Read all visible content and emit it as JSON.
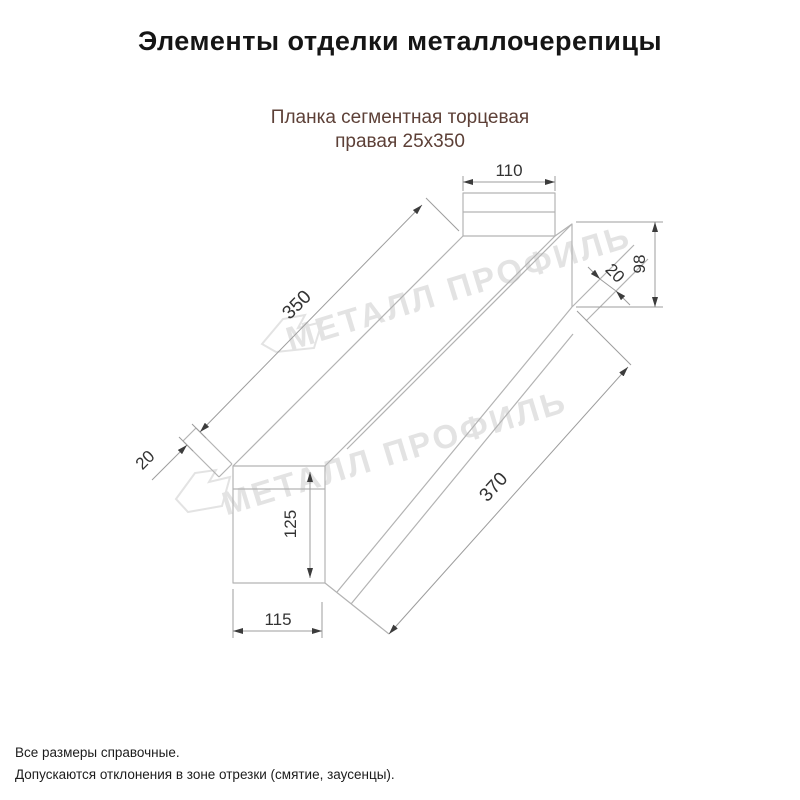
{
  "title": "Элементы отделки металлочерепицы",
  "product": {
    "line1": "Планка сегментная торцевая",
    "line2": "правая 25х350"
  },
  "drawing": {
    "dim_top_width": "110",
    "dim_length": "350",
    "dim_hem_left": "20",
    "dim_hem_right": "20",
    "dim_right_height": "98",
    "dim_left_height": "125",
    "dim_bottom_width": "115",
    "dim_face_length": "370"
  },
  "watermark": {
    "text": "МЕТАЛЛ ПРОФИЛЬ",
    "logo": "metall-profil-logomark"
  },
  "notes": {
    "line1": "Все размеры справочные.",
    "line2": "Допускаются отклонения в зоне отрезки (смятие, заусенцы)."
  },
  "colors": {
    "title": "#151515",
    "subtitle": "#5d4037",
    "footer": "#1c1c1c",
    "watermark": "#e3e3e3",
    "line": "#b3b3b3",
    "dim": "#9c9c9c",
    "arrow": "#3c3c3c",
    "text": "#333333"
  }
}
